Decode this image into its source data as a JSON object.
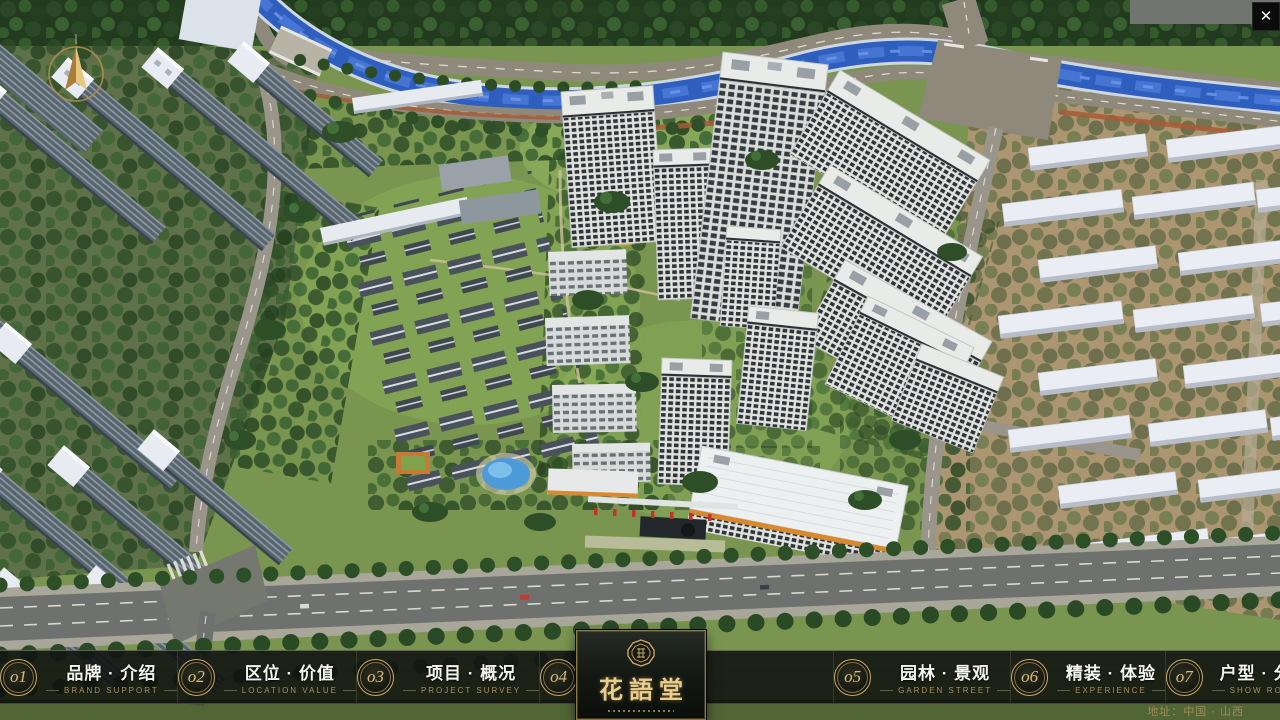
{
  "window": {
    "close_glyph": "✕"
  },
  "logo": {
    "name": "花語堂"
  },
  "footer": {
    "address": "地址：中国 · 山西"
  },
  "menu": {
    "items": [
      {
        "number": "o1",
        "title": "品牌 · 介绍",
        "subtitle": "BRAND SUPPORT"
      },
      {
        "number": "o2",
        "title": "区位 · 价值",
        "subtitle": "LOCATION VALUE"
      },
      {
        "number": "o3",
        "title": "项目 · 概况",
        "subtitle": "PROJECT SURVEY"
      },
      {
        "number": "o4",
        "title": "建筑 · 鉴赏",
        "subtitle": "APPRECIATION"
      },
      {
        "number": "o5",
        "title": "园林 · 景观",
        "subtitle": "GARDEN STREET"
      },
      {
        "number": "o6",
        "title": "精装 · 体验",
        "subtitle": "EXPERIENCE"
      },
      {
        "number": "o7",
        "title": "户型 · 分布",
        "subtitle": "SHOW ROOM"
      },
      {
        "number": "o8",
        "title": "一房 · 一景",
        "subtitle": "COMMUNITY"
      }
    ]
  }
}
